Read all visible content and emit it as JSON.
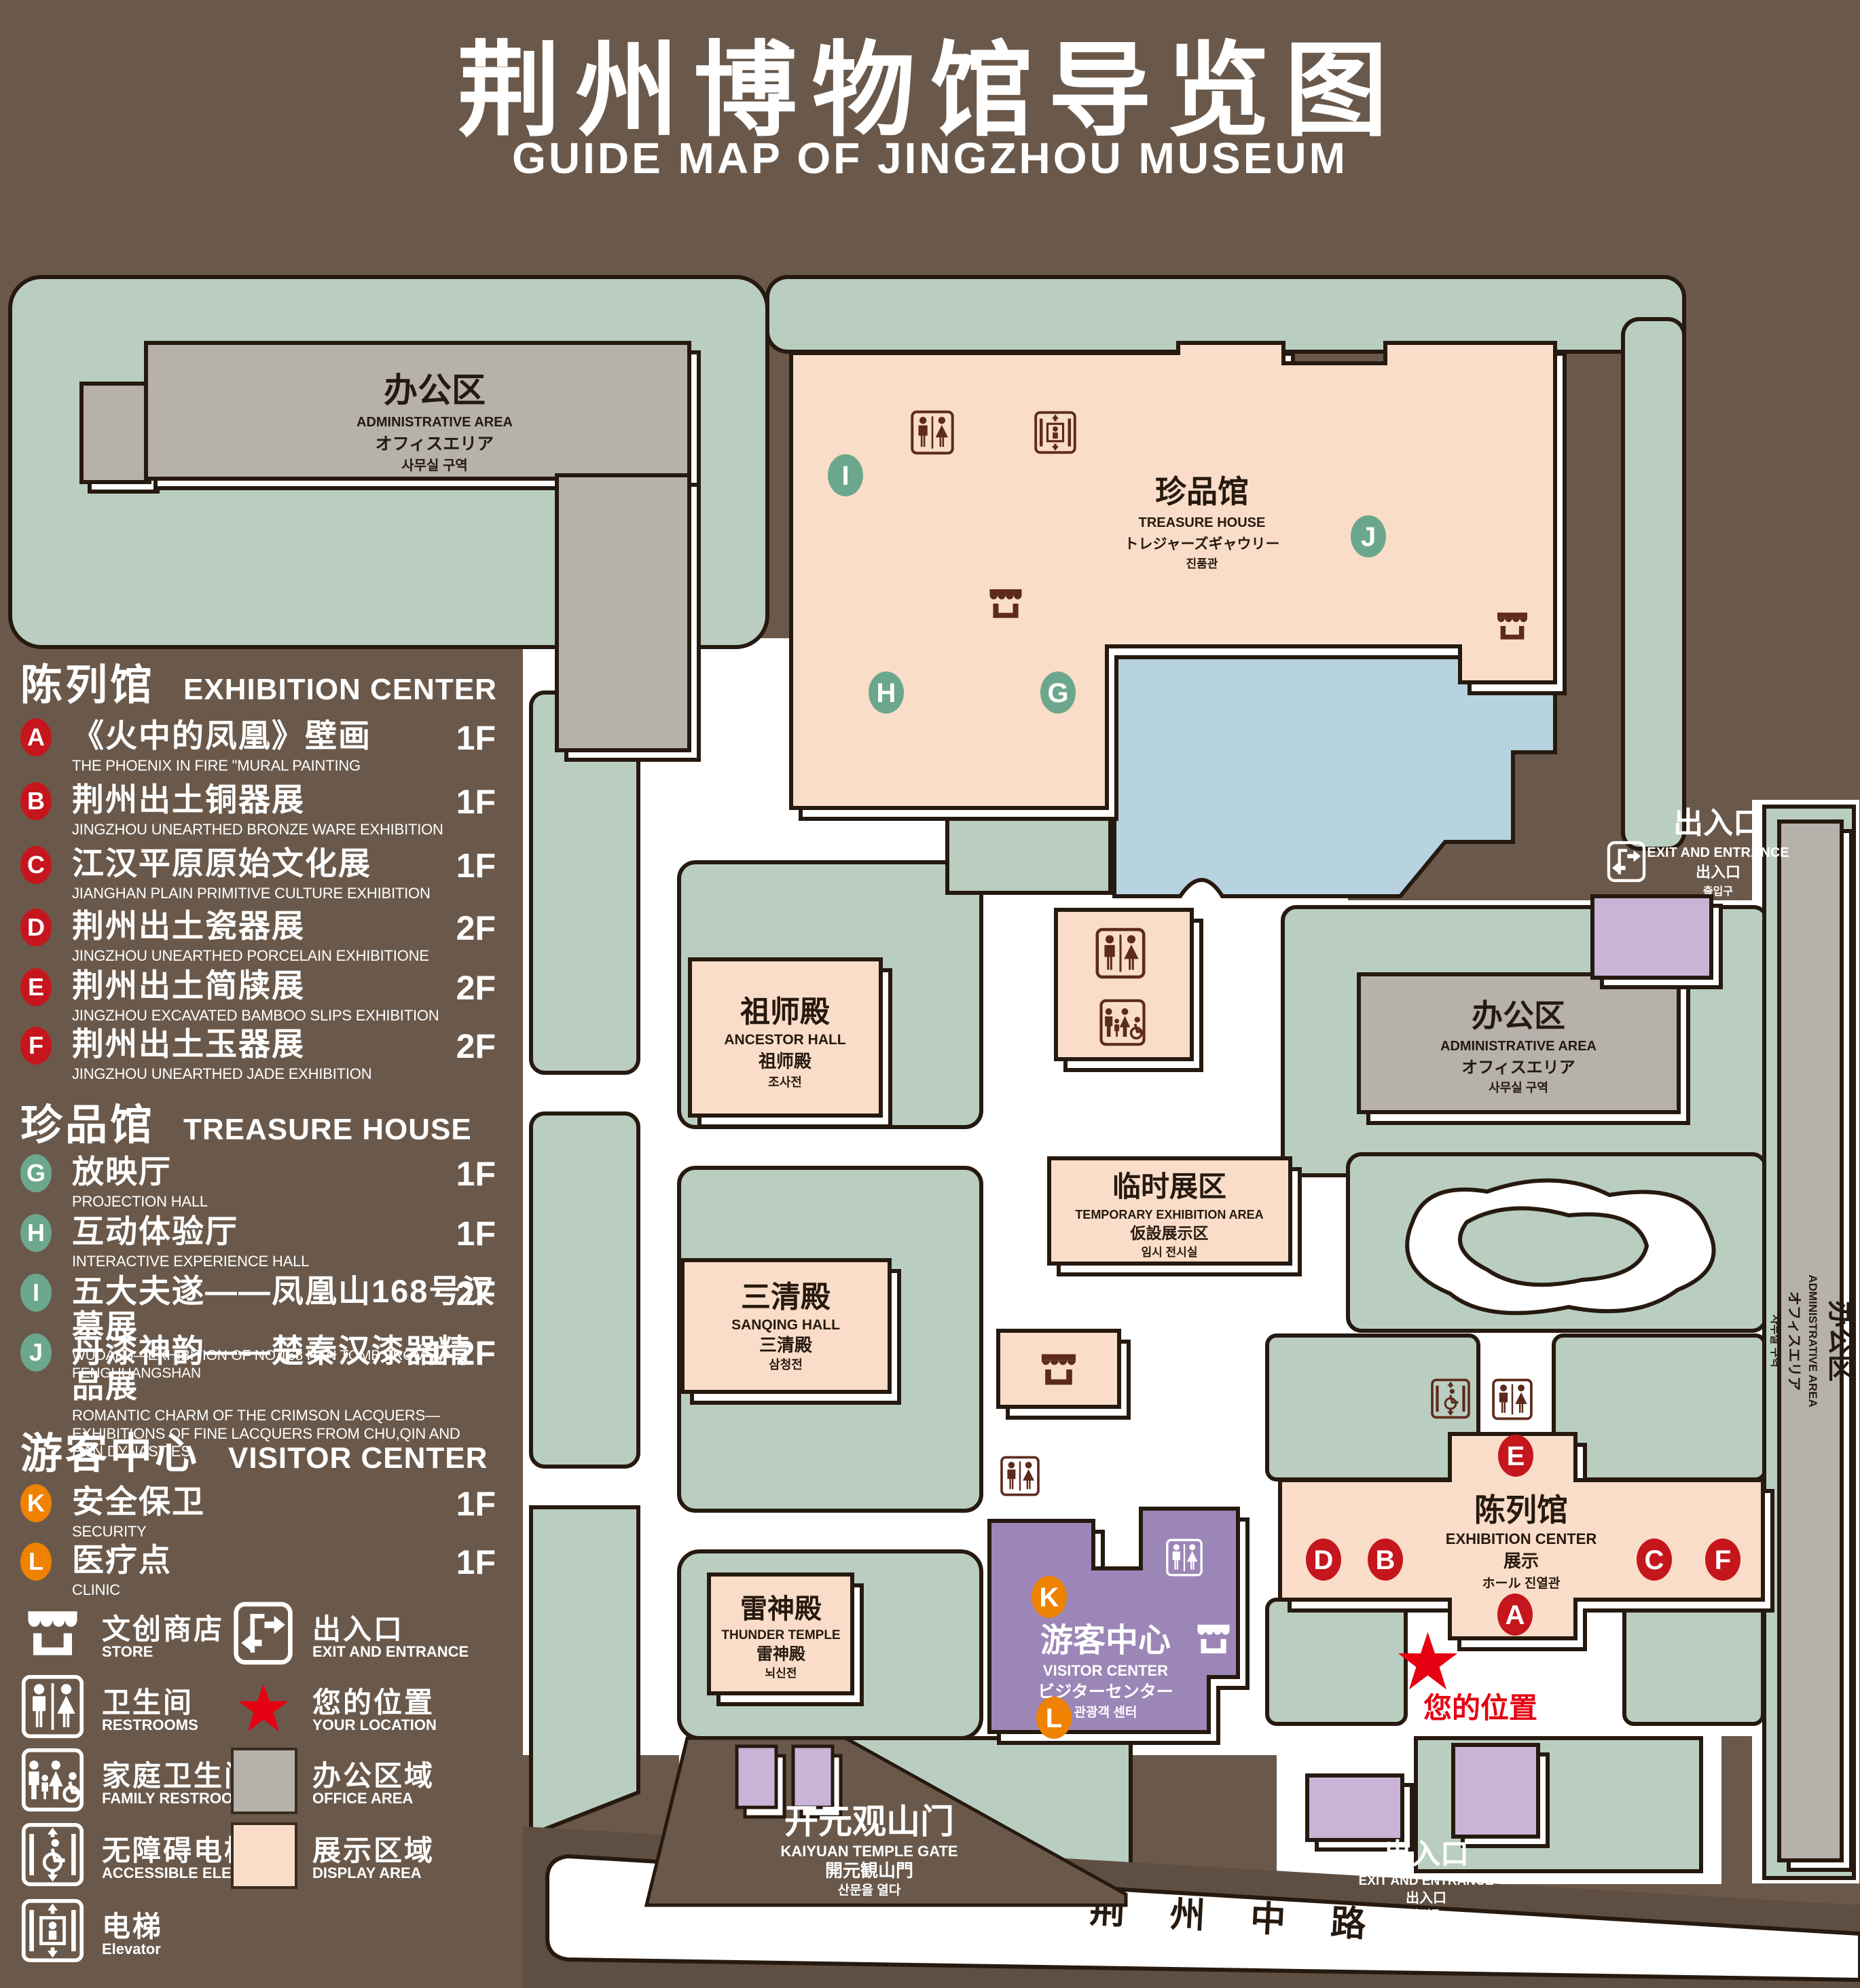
{
  "title": {
    "cn": "荆州博物馆导览图",
    "en": "GUIDE MAP OF JINGZHOU MUSEUM"
  },
  "legend": {
    "sections": [
      {
        "cn": "陈列馆",
        "en": "EXHIBITION CENTER",
        "items": [
          {
            "key": "A",
            "cn": "《火中的凤凰》壁画",
            "en": "THE PHOENIX IN FIRE \"MURAL PAINTING",
            "floor": "1F"
          },
          {
            "key": "B",
            "cn": "荆州出土铜器展",
            "en": "JINGZHOU UNEARTHED BRONZE WARE EXHIBITION",
            "floor": "1F"
          },
          {
            "key": "C",
            "cn": "江汉平原原始文化展",
            "en": "JIANGHAN PLAIN PRIMITIVE CULTURE EXHIBITION",
            "floor": "1F"
          },
          {
            "key": "D",
            "cn": "荆州出土瓷器展",
            "en": "JINGZHOU UNEARTHED PORCELAIN EXHIBITIONE",
            "floor": "2F"
          },
          {
            "key": "E",
            "cn": "荆州出土简牍展",
            "en": "JINGZHOU EXCAVATED BAMBOO SLIPS EXHIBITION",
            "floor": "2F"
          },
          {
            "key": "F",
            "cn": "荆州出土玉器展",
            "en": "JINGZHOU UNEARTHED JADE EXHIBITION",
            "floor": "2F"
          }
        ]
      },
      {
        "cn": "珍品馆",
        "en": "TREASURE HOUSE",
        "items": [
          {
            "key": "G",
            "cn": "放映厅",
            "en": "PROJECTION HALL",
            "floor": "1F"
          },
          {
            "key": "H",
            "cn": "互动体验厅",
            "en": "INTERACTIVE EXPERIENCE HALL",
            "floor": "1F"
          },
          {
            "key": "I",
            "cn": "五大夫遂——凤凰山168号汉墓展",
            "en": "WUDAFU—EXHIBITION OF NO.168 HAN TOMB FROM FENGHUANGSHAN",
            "floor": "2F"
          },
          {
            "key": "J",
            "cn": "丹漆神韵——楚秦汉漆器精品展",
            "en": "ROMANTIC CHARM OF THE CRIMSON LACQUERS—EXHIBITIONS OF FINE LACQUERS FROM CHU,QIN AND HAN DYNASTIES",
            "floor": "1-2F"
          }
        ]
      },
      {
        "cn": "游客中心",
        "en": "VISITOR CENTER",
        "items": [
          {
            "key": "K",
            "cn": "安全保卫",
            "en": "SECURITY",
            "floor": "1F"
          },
          {
            "key": "L",
            "cn": "医疗点",
            "en": "CLINIC",
            "floor": "1F"
          }
        ]
      }
    ],
    "symbols": {
      "store": {
        "cn": "文创商店",
        "en": "STORE"
      },
      "exit": {
        "cn": "出入口",
        "en": "EXIT AND ENTRANCE"
      },
      "restrooms": {
        "cn": "卫生间",
        "en": "RESTROOMS"
      },
      "location": {
        "cn": "您的位置",
        "en": "YOUR LOCATION"
      },
      "family": {
        "cn": "家庭卫生间",
        "en": "FAMILY RESTROOMS"
      },
      "office": {
        "cn": "办公区域",
        "en": "OFFICE AREA"
      },
      "accessible": {
        "cn": "无障碍电梯",
        "en": "ACCESSIBLE ELEVATOR"
      },
      "display": {
        "cn": "展示区域",
        "en": "DISPLAY AREA"
      },
      "elevator": {
        "cn": "电梯",
        "en": "Elevator"
      }
    }
  },
  "map": {
    "admin_tl": {
      "cn": "办公区",
      "en": "ADMINISTRATIVE AREA",
      "jp": "オフィスエリア",
      "kr": "사무실 구역"
    },
    "admin_r": {
      "cn": "办公区",
      "en": "ADMINISTRATIVE AREA",
      "jp": "オフィスエリア",
      "kr": "사무실 구역"
    },
    "admin_strip": {
      "cn": "办公区",
      "en": "ADMINISTRATIVE AREA",
      "jp": "オフィスエリア",
      "kr": "사무실 구역"
    },
    "treasure": {
      "cn": "珍品馆",
      "en": "TREASURE HOUSE",
      "jp": "トレジャーズギャウリー",
      "kr": "진품관"
    },
    "ancestor": {
      "cn": "祖师殿",
      "en": "ANCESTOR HALL",
      "cn2": "祖师殿",
      "kr": "조사전"
    },
    "sanqing": {
      "cn": "三清殿",
      "en": "SANQING HALL",
      "cn2": "三清殿",
      "kr": "삼청전"
    },
    "thunder": {
      "cn": "雷神殿",
      "en": "THUNDER TEMPLE",
      "cn2": "雷神殿",
      "kr": "뇌신전"
    },
    "temp": {
      "cn": "临时展区",
      "en": "TEMPORARY EXHIBITION AREA",
      "jp": "仮設展示区",
      "kr": "임시 전시실"
    },
    "exhibition": {
      "cn": "陈列馆",
      "en": "EXHIBITION CENTER",
      "cn2": "展示",
      "mix": "ホール 진열관"
    },
    "visitor": {
      "cn": "游客中心",
      "en": "VISITOR CENTER",
      "jp": "ビジターセンター",
      "kr": "관광객 센터"
    },
    "exit_tr": {
      "cn": "出入口",
      "en": "EXIT AND ENTRANCE",
      "cn2": "出入口",
      "kr": "출입구"
    },
    "exit_br": {
      "cn": "出入口",
      "en": "EXIT AND ENTRANCE",
      "cn2": "出入口",
      "kr": "출입구"
    },
    "gate": {
      "cn": "开元观山门",
      "en": "KAIYUAN TEMPLE GATE",
      "jp": "開元観山門",
      "kr": "산문을 열다"
    },
    "road": {
      "label": "荆 州 中 路"
    },
    "your_location": {
      "cn": "您的位置"
    },
    "markers": {
      "A": "A",
      "B": "B",
      "C": "C",
      "D": "D",
      "E": "E",
      "F": "F",
      "G": "G",
      "H": "H",
      "I": "I",
      "J": "J",
      "K": "K",
      "L": "L"
    }
  },
  "colors": {
    "background": "#6A594B",
    "lawn": "#B9CEC1",
    "display_area": "#F9DDC8",
    "office_area": "#B6B1AB",
    "visitor_center": "#9C86B7",
    "entrance_block": "#C9B4D8",
    "lake": "#B7D3E0",
    "outline": "#26190F",
    "marker_red": "#C5161D",
    "marker_green": "#6BA78C",
    "marker_orange": "#EF8200",
    "icon_brown": "#5D2A1B",
    "location_red": "#E60012"
  }
}
